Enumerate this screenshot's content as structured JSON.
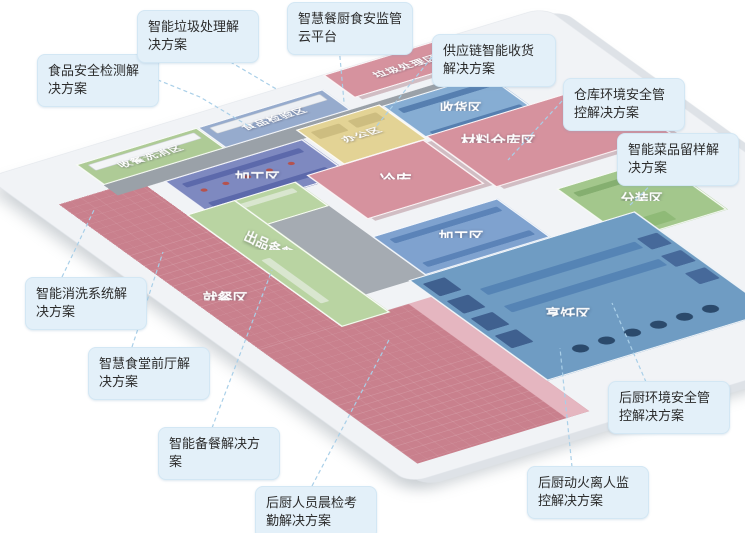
{
  "diagram": {
    "title": "智慧餐厨食安监管园区平面图",
    "zones": [
      {
        "id": "wash-return",
        "label": "收餐洗消区"
      },
      {
        "id": "food-inspection",
        "label": "食品检验区"
      },
      {
        "id": "waste-treatment",
        "label": "垃圾处理区"
      },
      {
        "id": "office",
        "label": "办公区"
      },
      {
        "id": "receiving",
        "label": "收货区"
      },
      {
        "id": "material-warehouse",
        "label": "材料仓库区"
      },
      {
        "id": "processing-1",
        "label": "加工区"
      },
      {
        "id": "cold-storage",
        "label": "冷库"
      },
      {
        "id": "processing-2",
        "label": "加工区"
      },
      {
        "id": "packing",
        "label": "分装区"
      },
      {
        "id": "serving-prep",
        "label": "出品备餐区"
      },
      {
        "id": "dining",
        "label": "就餐区"
      },
      {
        "id": "cooking",
        "label": "烹饪区"
      }
    ],
    "callouts": [
      {
        "id": "food-safety-testing",
        "label": "食品安全检测解决方案"
      },
      {
        "id": "smart-waste",
        "label": "智能垃圾处理解决方案"
      },
      {
        "id": "cloud-platform",
        "label": "智慧餐厨食安监管云平台"
      },
      {
        "id": "supply-chain-receiving",
        "label": "供应链智能收货解决方案"
      },
      {
        "id": "warehouse-env-safety",
        "label": "仓库环境安全管控解决方案"
      },
      {
        "id": "dish-sample-retention",
        "label": "智能菜品留样解决方案"
      },
      {
        "id": "smart-washing",
        "label": "智能消洗系统解决方案"
      },
      {
        "id": "front-hall",
        "label": "智慧食堂前厅解决方案"
      },
      {
        "id": "smart-meal-prep",
        "label": "智能备餐解决方案"
      },
      {
        "id": "staff-morning-check",
        "label": "后厨人员晨检考勤解决方案"
      },
      {
        "id": "fire-unattended-monitor",
        "label": "后厨动火离人监控解决方案"
      },
      {
        "id": "kitchen-env-safety",
        "label": "后厨环境安全管控解决方案"
      }
    ],
    "colors": {
      "callout_bg": "#e3f0f9",
      "connector": "#a9cfe8",
      "floor_pink": "#c9808d",
      "roof_pink": "#d6929e",
      "walkway_pink": "#e5b6c0",
      "green_strip": "#aecb96",
      "green_serving": "#b9d4a2",
      "green_room": "#a3c78c",
      "yellow_office": "#e3d395",
      "blue_receiving": "#86add3",
      "blue_processing_dark": "#7e89c0",
      "blue_processing": "#7fa2cf",
      "blue_cooking": "#6f9cc3",
      "blue_inspection": "#96abcd",
      "corridor_gray": "#9aa1a8",
      "slab": "#f1f3f6"
    }
  }
}
